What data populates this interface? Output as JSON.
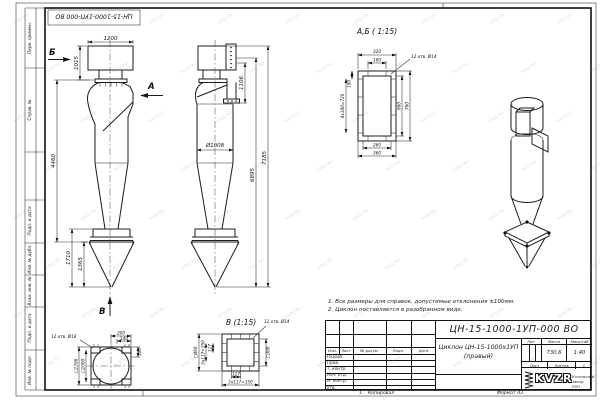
{
  "watermark": {
    "text": "KVZC.RU"
  },
  "stamp_top": {
    "text": "ЦН-15-1000-1УП-000 ВО"
  },
  "frame": {
    "sidebar_labels": [
      "Перв. примен.",
      "Справ. №",
      "Подп. и дата",
      "Инв. № дубл.",
      "Взам. инв. №",
      "Подп. и дата",
      "Инв. № подл."
    ]
  },
  "views": {
    "front": {
      "dims": {
        "width": "1200",
        "top_height": "1015",
        "body_height": "4460",
        "cone_outer": "1710",
        "cone_inner": "1365"
      },
      "arrows": {
        "b": "Б",
        "a": "А",
        "v": "В"
      }
    },
    "side": {
      "dims": {
        "flange_offset": "1106",
        "diameter": "Ø1008",
        "height_inner": "6895",
        "height_total": "7185"
      }
    },
    "section_ab": {
      "title": "А,Б ( 1:15)",
      "holes_note": "12 отв. Ø14",
      "dims": {
        "w320": "320",
        "w160": "160",
        "h190": "190",
        "h720": "4x180=720",
        "h660": "660",
        "h760": "760",
        "w260": "260",
        "w360": "360"
      }
    },
    "section_v": {
      "title": "В (1:15)",
      "holes_note": "12 отв. Ø14",
      "dims": {
        "sq460": "□460",
        "l350": "3x117=350",
        "l117": "117",
        "sq300": "□300",
        "b117": "117",
        "b350": "3x117=350"
      }
    },
    "base": {
      "holes_note": "12 отв. Ø18",
      "dims": {
        "sq1206": "□1206",
        "sq1060": "□1060",
        "w200": "200",
        "w140": "140",
        "h100": "100"
      }
    }
  },
  "notes": [
    "1. Все размеры для справок, допустимые отклонения ±100мм.",
    "2. Циклон поставляется в разобранном виде."
  ],
  "titleblock": {
    "doc_number": "ЦН-15-1000-1УП-000 ВО",
    "name_line1": "Циклон ЦН-15-1000х1УП",
    "name_line2": "(правый)",
    "header_cols": [
      "Изм.",
      "Лист",
      "№ докум.",
      "Подп.",
      "Дата"
    ],
    "sig_rows": [
      "Разраб.",
      "Пров.",
      "Т. контр.",
      "Нач. отд.",
      "Н. контр.",
      "Утв."
    ],
    "lit_label": "Лит.",
    "mass_label": "Масса",
    "scale_label": "Масштаб",
    "mass_value": "730,6",
    "scale_value": "1:40",
    "sheet_label": "Лист",
    "sheets_label": "Листов",
    "sheets_value": "1",
    "logo_text": "KVZR",
    "company_line1": "Котельный",
    "company_line2": "завод РЭП"
  },
  "footer": {
    "num": "1",
    "copied": "Копировал",
    "format": "Формат А3"
  }
}
